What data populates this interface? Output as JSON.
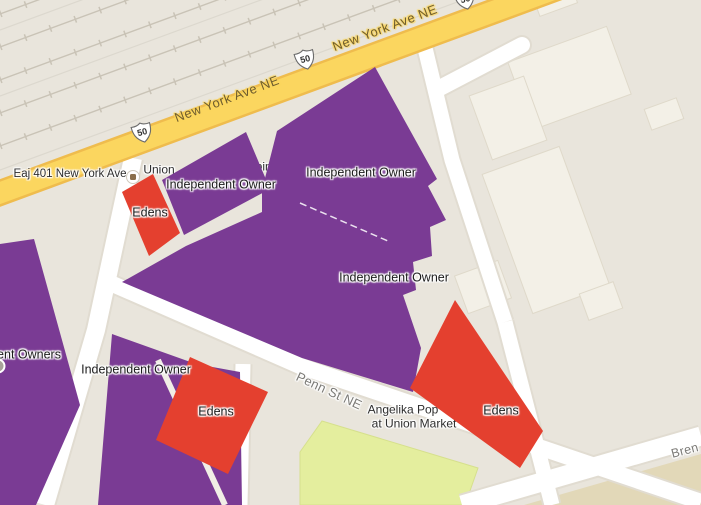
{
  "map": {
    "roads": {
      "new_york_ave": {
        "label": "New York Ave NE",
        "route_shield": "50"
      },
      "fourth_st": {
        "label": "4th St NE"
      },
      "penn_st": {
        "label": "Penn St NE"
      },
      "brentwood": {
        "label_fragment": "Bren"
      }
    },
    "base_labels": {
      "eaj_401": "Eaj 401 New York Ave",
      "union_fragment": "Union",
      "shopping_fragment": "pping W",
      "angelika_line1": "Angelika Pop",
      "angelika_line2": "at Union Market",
      "address_fragment": "5",
      "poi_fragment_line1": "e &",
      "poi_fragment_line2": "rchar"
    },
    "overlays": {
      "independent_owner_label": "Independent Owner",
      "independent_owners_partial_label": "ent Owners",
      "edens_label": "Edens",
      "independent_owner_color": "#7A3B94",
      "edens_color": "#E4402F"
    },
    "palette": {
      "background": "#E9E5DC",
      "building_fill": "#F3F0E7",
      "building_stroke": "#DFD9CA",
      "road_fill": "#FFFFFF",
      "road_casing": "#E1DCD1",
      "highway_fill": "#FBD65F",
      "highway_casing": "#EFBC4D",
      "green_building": "#E4EE9E",
      "green_building_stroke": "#D6E08D",
      "tan_ground": "#E2D8B8",
      "railroad": "#C9C3B6",
      "railroad_faint": "#DCD8CE",
      "gap_stripe": "#F1EEE6"
    }
  }
}
